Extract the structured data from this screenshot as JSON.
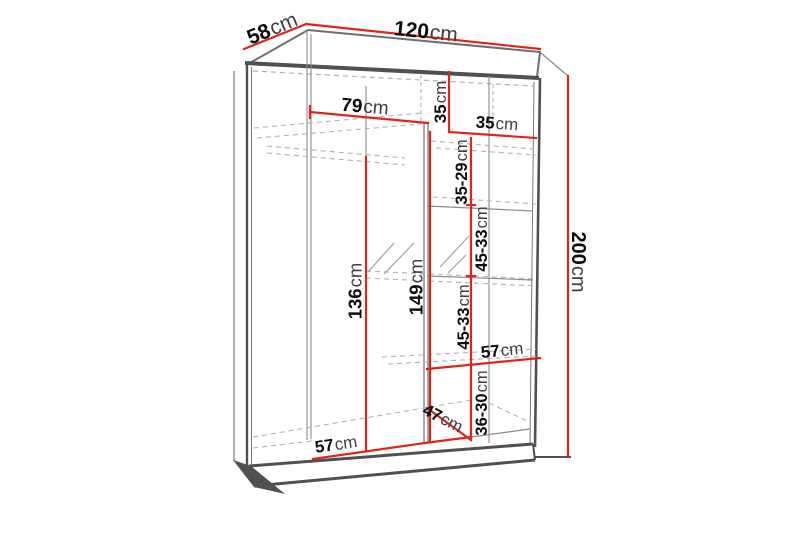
{
  "diagram": {
    "type": "wardrobe-dimension-diagram",
    "unit": "cm",
    "colors": {
      "dimension_line": "#e2231a",
      "structure_dark": "#4f5052",
      "structure_mid": "#77787b",
      "hidden_dashed": "#b0b2b5",
      "number_text": "#0d0d0d",
      "unit_text": "#3f3f3f",
      "background": "#ffffff"
    },
    "dims": {
      "width120": {
        "v": "120",
        "u": "cm"
      },
      "depth58": {
        "v": "58",
        "u": "cm"
      },
      "height200": {
        "v": "200",
        "u": "cm"
      },
      "inner79": {
        "v": "79",
        "u": "cm"
      },
      "top35v": {
        "v": "35",
        "u": "cm"
      },
      "top35h": {
        "v": "35",
        "u": "cm"
      },
      "gap3529": {
        "v": "35-29",
        "u": "cm"
      },
      "gap4533a": {
        "v": "45-33",
        "u": "cm"
      },
      "gap4533b": {
        "v": "45-33",
        "u": "cm"
      },
      "left136": {
        "v": "136",
        "u": "cm"
      },
      "mid149": {
        "v": "149",
        "u": "cm"
      },
      "right57": {
        "v": "57",
        "u": "cm"
      },
      "gap3630": {
        "v": "36-30",
        "u": "cm"
      },
      "depth47": {
        "v": "47",
        "u": "cm"
      },
      "bottom57": {
        "v": "57",
        "u": "cm"
      }
    }
  }
}
